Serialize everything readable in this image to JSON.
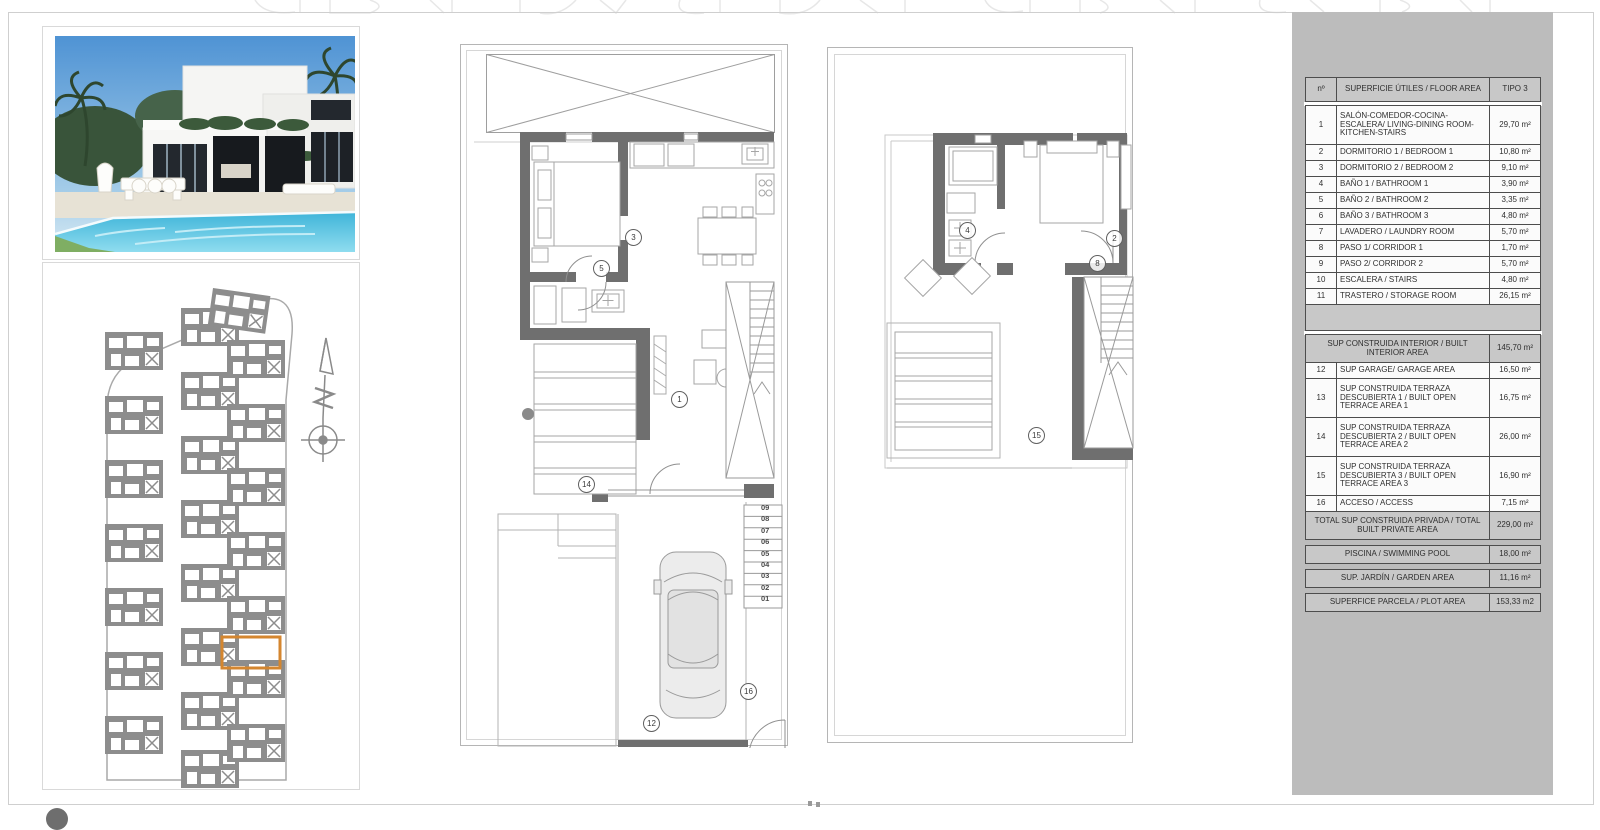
{
  "sheet": {
    "accent_colors": {
      "panel_gray": "#bcbcbc",
      "table_line": "#4d4d4d",
      "band_gray": "#c8c8c8",
      "wall_gray": "#6f6f6f",
      "site_gray": "#8d8d8d",
      "highlight_orange": "#d4862f"
    }
  },
  "area_table": {
    "header": {
      "num": "nº",
      "title": "SUPERFICIE ÚTILES / FLOOR AREA",
      "type": "TIPO 3"
    },
    "rooms": [
      {
        "num": "1",
        "name": "SALÓN-COMEDOR-COCINA-ESCALERA/ LIVING-DINING ROOM-KITCHEN-STAIRS",
        "value": "29,70 m²"
      },
      {
        "num": "2",
        "name": "DORMITORIO 1 / BEDROOM 1",
        "value": "10,80 m²"
      },
      {
        "num": "3",
        "name": "DORMITORIO 2 / BEDROOM 2",
        "value": "9,10 m²"
      },
      {
        "num": "4",
        "name": "BAÑO 1 / BATHROOM 1",
        "value": "3,90 m²"
      },
      {
        "num": "5",
        "name": "BAÑO 2 / BATHROOM 2",
        "value": "3,35 m²"
      },
      {
        "num": "6",
        "name": "BAÑO 3 / BATHROOM 3",
        "value": "4,80 m²"
      },
      {
        "num": "7",
        "name": "LAVADERO / LAUNDRY ROOM",
        "value": "5,70 m²"
      },
      {
        "num": "8",
        "name": "PASO 1/ CORRIDOR 1",
        "value": "1,70 m²"
      },
      {
        "num": "9",
        "name": "PASO 2/ CORRIDOR 2",
        "value": "5,70 m²"
      },
      {
        "num": "10",
        "name": "ESCALERA / STAIRS",
        "value": "4,80 m²"
      },
      {
        "num": "11",
        "name": "TRASTERO / STORAGE ROOM",
        "value": "26,15 m²"
      }
    ],
    "sections": [
      {
        "kind": "band",
        "label": "SUP CONSTRUIDA INTERIOR / BUILT INTERIOR AREA",
        "value": "145,70 m²"
      },
      {
        "kind": "room",
        "num": "12",
        "label": "SUP GARAGE/ GARAGE AREA",
        "value": "16,50 m²"
      },
      {
        "kind": "room",
        "num": "13",
        "label": "SUP CONSTRUIDA TERRAZA DESCUBIERTA 1 / BUILT OPEN TERRACE AREA 1",
        "value": "16,75 m²"
      },
      {
        "kind": "room",
        "num": "14",
        "label": "SUP CONSTRUIDA TERRAZA DESCUBIERTA 2 / BUILT OPEN TERRACE AREA 2",
        "value": "26,00 m²"
      },
      {
        "kind": "room",
        "num": "15",
        "label": "SUP CONSTRUIDA TERRAZA DESCUBIERTA 3 / BUILT OPEN TERRACE AREA 3",
        "value": "16,90 m²"
      },
      {
        "kind": "room",
        "num": "16",
        "label": "ACCESO / ACCESS",
        "value": "7,15 m²"
      },
      {
        "kind": "band",
        "label": "TOTAL SUP CONSTRUIDA PRIVADA / TOTAL BUILT PRIVATE AREA",
        "value": "229,00 m²"
      }
    ],
    "totals": [
      {
        "label": "PISCINA / SWIMMING POOL",
        "value": "18,00 m²"
      },
      {
        "label": "SUP. JARDÍN / GARDEN AREA",
        "value": "11,16 m²"
      },
      {
        "label": "SUPERFICE PARCELA / PLOT AREA",
        "value": "153,33 m2"
      }
    ]
  },
  "plans": {
    "ground": {
      "labels": [
        "3",
        "5",
        "1",
        "14",
        "12",
        "16"
      ],
      "steps": [
        "09",
        "08",
        "07",
        "06",
        "05",
        "04",
        "03",
        "02",
        "01"
      ]
    },
    "first": {
      "labels": [
        "4",
        "2",
        "8",
        "15"
      ]
    }
  }
}
